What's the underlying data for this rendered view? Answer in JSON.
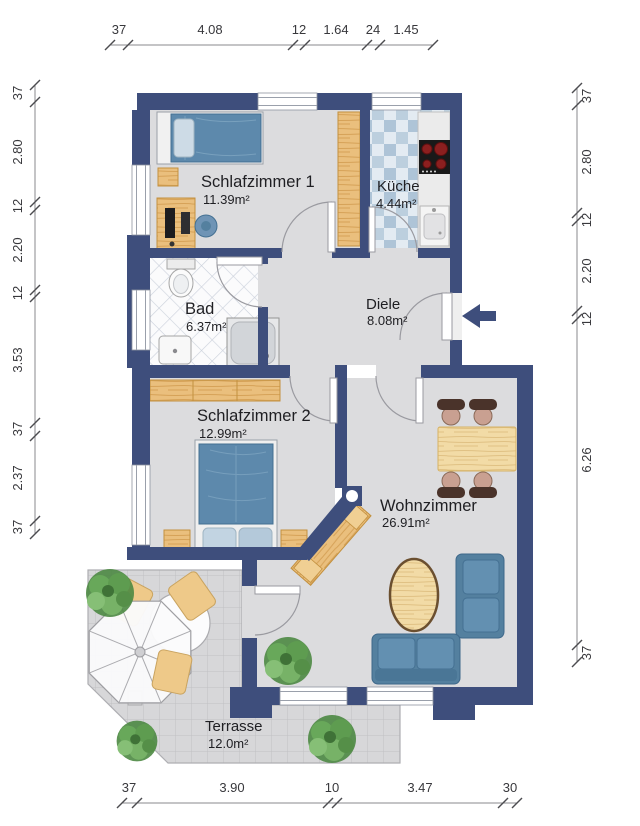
{
  "plan": {
    "title": "apartment-floor-plan",
    "rooms": [
      {
        "id": "schlafzimmer1",
        "name": "Schlafzimmer 1",
        "area": "11.39m²"
      },
      {
        "id": "kueche",
        "name": "Küche",
        "area": "4.44m²"
      },
      {
        "id": "bad",
        "name": "Bad",
        "area": "6.37m²"
      },
      {
        "id": "diele",
        "name": "Diele",
        "area": "8.08m²"
      },
      {
        "id": "schlafzimmer2",
        "name": "Schlafzimmer 2",
        "area": "12.99m²"
      },
      {
        "id": "wohnzimmer",
        "name": "Wohnzimmer",
        "area": "26.91m²"
      },
      {
        "id": "terrasse",
        "name": "Terrasse",
        "area": "12.0m²"
      }
    ],
    "dimensions": {
      "top": [
        "37",
        "4.08",
        "12",
        "1.64",
        "24",
        "1.45"
      ],
      "left": [
        "37",
        "2.80",
        "12",
        "2.20",
        "12",
        "3.53",
        "37",
        "2.37",
        "37"
      ],
      "right": [
        "37",
        "2.80",
        "12",
        "2.20",
        "12",
        "6.26",
        "37"
      ],
      "bottom": [
        "37",
        "3.90",
        "10",
        "3.47",
        "30"
      ]
    },
    "icons": {
      "entrance_arrow": "arrow-left"
    },
    "colors": {
      "wall": "#3e4e7c",
      "floor": "#dcdcde",
      "kitchen_tile": "#b0c5d8",
      "bath_tile_line": "#ccd2dc",
      "terrace_tile": "#d7d7d9",
      "wood": "#eabf7d",
      "wood_light": "#f2dba6",
      "upholstery_blue": "#5d89ac",
      "plant_green": "#5a9a4e",
      "stove_burner": "#8c1f1f",
      "dimension_text": "#38383c"
    }
  }
}
